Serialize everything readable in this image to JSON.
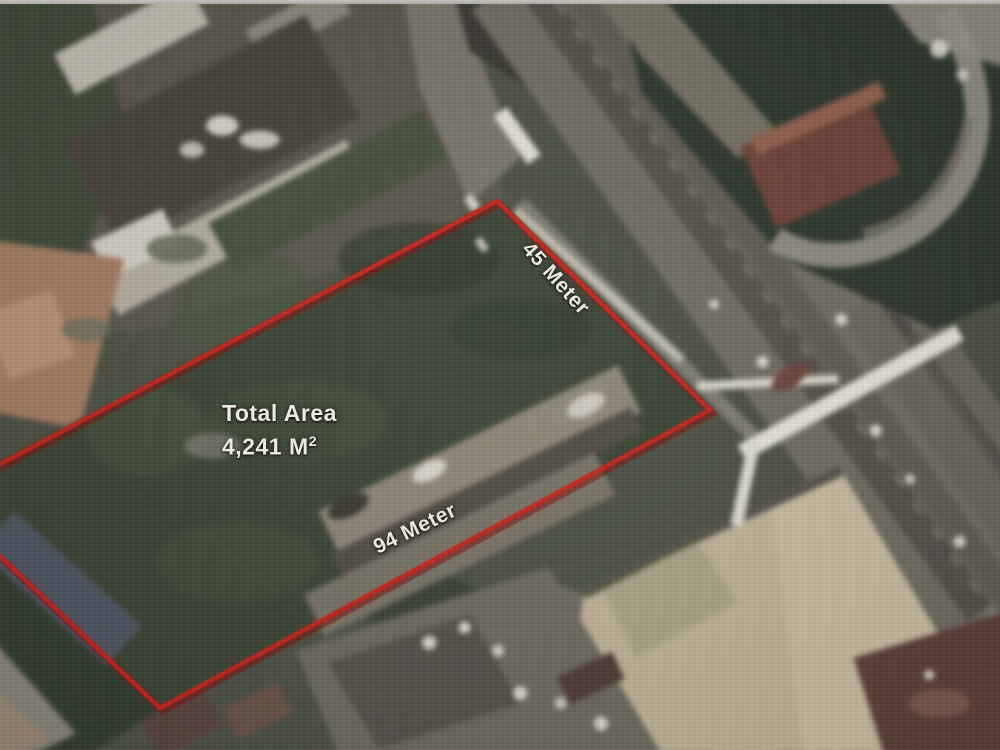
{
  "map": {
    "kind": "annotated-satellite-photo",
    "parcel": {
      "total_area_title": "Total Area",
      "total_area_value": "4,241 M",
      "total_area_exponent": "2",
      "side_labels": [
        {
          "id": "side-45",
          "text": "45 Meter"
        },
        {
          "id": "side-94",
          "text": "94 Meter"
        }
      ],
      "boundary_color": "#c9231a",
      "label_text_color": "#edebe0"
    }
  }
}
